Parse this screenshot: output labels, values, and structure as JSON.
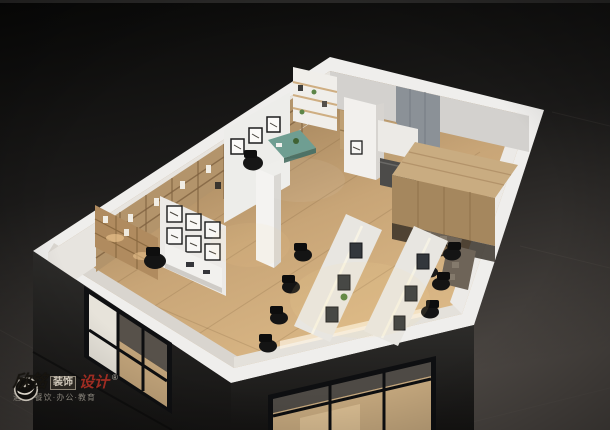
{
  "image": {
    "type": "3d-interior-render",
    "subject": "isometric cutaway model of an office interior on a dark studio floor",
    "rooms": [
      "reception with gallery wall",
      "manager office with teal desk",
      "open office with two workstation rows",
      "timber canopy lounge with sofas"
    ]
  },
  "palette": {
    "background_top": "#0a0a09",
    "background_floor": "#4a4541",
    "exterior_wall": "#22211f",
    "wall_top_band": "#f0efec",
    "wood_floor": "#c8a577",
    "bookshelf_wood": "#b3946b",
    "canopy_wood": "#c9ac81",
    "desk_white": "#e8e6e1",
    "office_chair_black": "#141414",
    "sofa_taupe": "#6e6458",
    "manager_desk_teal": "#6f9e92",
    "door_panel_gray": "#8b9197",
    "red_accent": "#c23326"
  },
  "watermark": {
    "logo": "circular-swoosh-emblem",
    "brand_script": "欣铭",
    "brand_boxed": "装饰",
    "brand_red": "设计",
    "registered": "®",
    "tagline": "酒店·餐饮·办公·教育"
  }
}
